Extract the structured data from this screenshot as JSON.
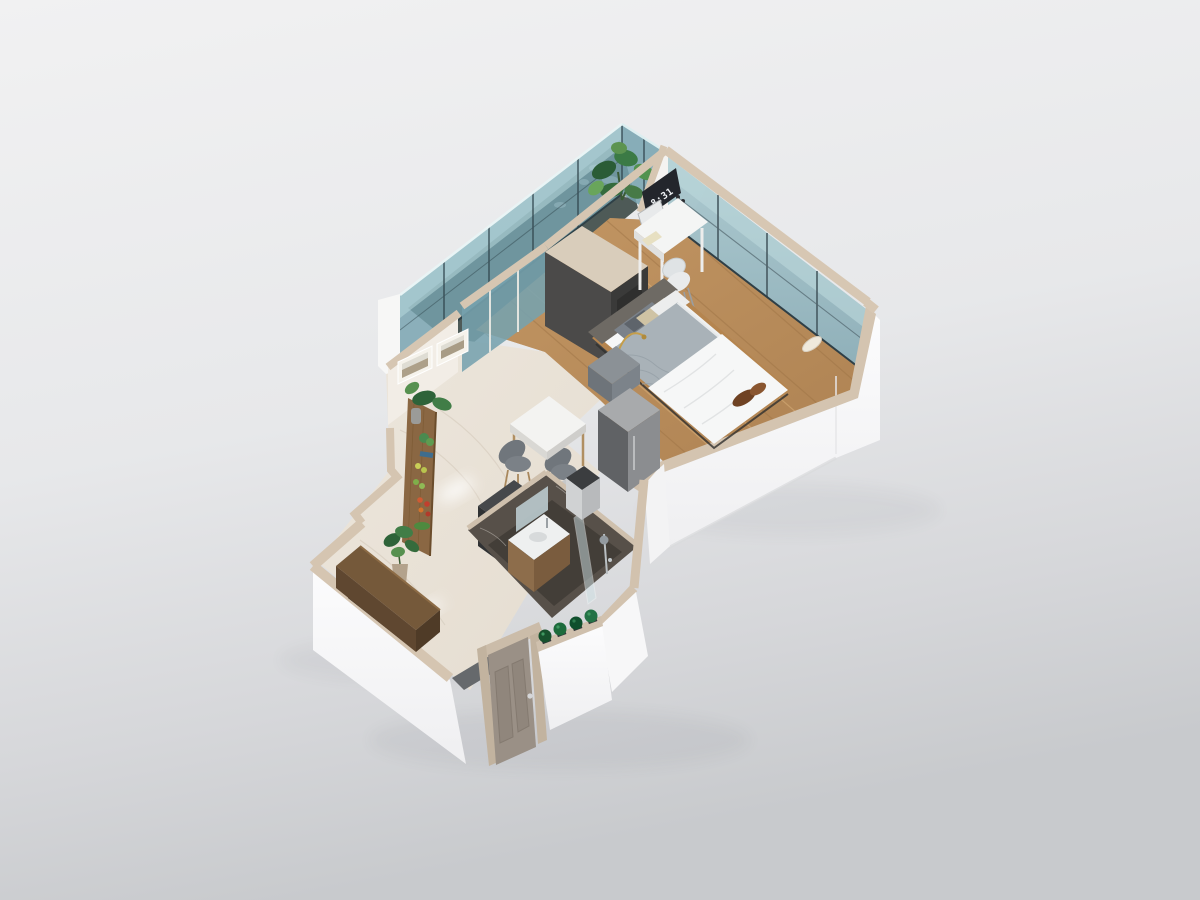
{
  "meta": {
    "title": "Isometric 3D floor plan render of a studio apartment",
    "render_type": "architectural 3D cutaway model"
  },
  "clock": {
    "time": "8:31"
  },
  "palette": {
    "background_top": "#f1f1f2",
    "background_bottom": "#caccd0",
    "wall_top": "#d6c6b2",
    "wall_white": "#fbfbfc",
    "glass": "#76a2ae",
    "glass_light": "#a9cdd3",
    "glass_frame": "#3e5159",
    "wood_floor": "#bb8e5d",
    "marble_floor": "#eae3d8",
    "bath_floor": "#433e38",
    "cabinet_charcoal": "#4b4a49",
    "wood_furniture": "#8a6743",
    "door": "#9a9086",
    "fabric_gray": "#70767c",
    "blanket": "#a9b2b8",
    "duvet": "#f6f7f7",
    "plant": "#35703f",
    "plant_dark": "#17512d",
    "brass": "#c59e4a",
    "throw_brown": "#6f4223"
  },
  "rooms": [
    {
      "id": "balcony",
      "label": "Balcony",
      "items": [
        "glass railing",
        "monstera plant",
        "pebble floor"
      ]
    },
    {
      "id": "bedroom",
      "label": "Bedroom",
      "items": [
        "double bed",
        "flip clock showing 8:31",
        "white desk",
        "desk chair",
        "charcoal wardrobe unit",
        "floor-to-ceiling window wall",
        "wood nightstand",
        "arc floor lamp",
        "gray bedside bench"
      ]
    },
    {
      "id": "living-dining",
      "label": "Living / Dining",
      "items": [
        "dining table",
        "2 gray chairs",
        "plant display board",
        "2 framed pictures",
        "mini fridge",
        "waste bin",
        "dark kitchenette counter"
      ]
    },
    {
      "id": "bathroom",
      "label": "Bathroom",
      "items": [
        "vanity sink",
        "mirror",
        "walk-in shower"
      ]
    },
    {
      "id": "entry",
      "label": "Entry",
      "items": [
        "entry door",
        "wood console bench",
        "monstera plant",
        "4 boxwood planters"
      ]
    }
  ]
}
